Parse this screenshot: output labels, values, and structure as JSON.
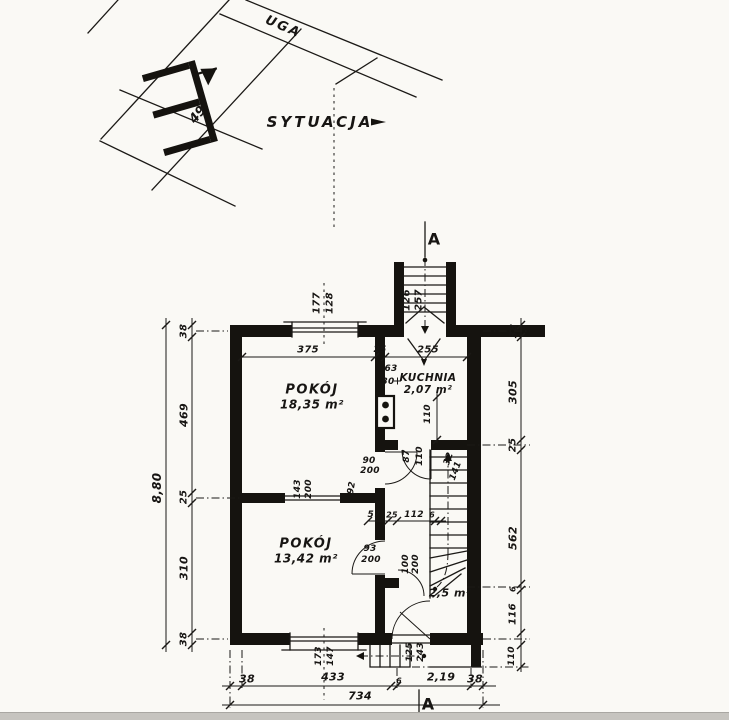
{
  "site_plan": {
    "street_name": "UGA",
    "title": "SYTUACJA",
    "building_number": "49"
  },
  "rooms": [
    {
      "name": "POKÓJ",
      "area": "18,35 m²"
    },
    {
      "name": "KUCHNIA",
      "area": "2,07 m²"
    },
    {
      "name": "POKÓJ",
      "area": "13,42 m²"
    },
    {
      "name": "",
      "area": "2,5 m²"
    }
  ],
  "section_markers": [
    {
      "label": "A"
    },
    {
      "label": "A"
    }
  ],
  "ink_color": "#15130f",
  "paper_color": "#faf9f5",
  "dimensions": [
    {
      "t": "177",
      "x": 317,
      "y": 303,
      "r": -90
    },
    {
      "t": "128",
      "x": 330,
      "y": 303,
      "r": -90
    },
    {
      "t": "126",
      "x": 407,
      "y": 300,
      "r": -90
    },
    {
      "t": "257",
      "x": 419,
      "y": 300,
      "r": -90
    },
    {
      "t": "375",
      "x": 308,
      "y": 350,
      "r": 0
    },
    {
      "t": "25",
      "x": 380,
      "y": 350,
      "r": 0,
      "s": 9
    },
    {
      "t": "255",
      "x": 428,
      "y": 350,
      "r": 0
    },
    {
      "t": "63",
      "x": 391,
      "y": 369,
      "r": 0,
      "s": 9
    },
    {
      "t": "30",
      "x": 388,
      "y": 382,
      "r": 0,
      "s": 9
    },
    {
      "t": "110",
      "x": 428,
      "y": 414,
      "r": -90,
      "s": 9
    },
    {
      "t": "87",
      "x": 407,
      "y": 456,
      "r": -90,
      "s": 9
    },
    {
      "t": "110",
      "x": 420,
      "y": 456,
      "r": -90,
      "s": 9
    },
    {
      "t": "90",
      "x": 369,
      "y": 461,
      "r": 0,
      "s": 9
    },
    {
      "t": "200",
      "x": 370,
      "y": 471,
      "r": 0,
      "s": 9
    },
    {
      "t": "32",
      "x": 449,
      "y": 459,
      "r": -70,
      "s": 9
    },
    {
      "t": "141",
      "x": 456,
      "y": 471,
      "r": -70,
      "s": 9
    },
    {
      "t": "57",
      "x": 374,
      "y": 515,
      "r": 0,
      "s": 9
    },
    {
      "t": "25",
      "x": 392,
      "y": 515,
      "r": 0,
      "s": 8
    },
    {
      "t": "112",
      "x": 414,
      "y": 515,
      "r": 0,
      "s": 9
    },
    {
      "t": "6",
      "x": 432,
      "y": 515,
      "r": 0,
      "s": 8
    },
    {
      "t": "93",
      "x": 370,
      "y": 549,
      "r": 0,
      "s": 9
    },
    {
      "t": "200",
      "x": 371,
      "y": 560,
      "r": 0,
      "s": 9
    },
    {
      "t": "100",
      "x": 406,
      "y": 564,
      "r": -90,
      "s": 9
    },
    {
      "t": "200",
      "x": 416,
      "y": 564,
      "r": -90,
      "s": 9
    },
    {
      "t": "143",
      "x": 298,
      "y": 489,
      "r": -90,
      "s": 9
    },
    {
      "t": "200",
      "x": 309,
      "y": 489,
      "r": -90,
      "s": 9
    },
    {
      "t": "92",
      "x": 352,
      "y": 488,
      "r": -80,
      "s": 9
    },
    {
      "t": "173",
      "x": 319,
      "y": 656,
      "r": -90,
      "s": 9
    },
    {
      "t": "147",
      "x": 331,
      "y": 656,
      "r": -90,
      "s": 9
    },
    {
      "t": "125",
      "x": 410,
      "y": 652,
      "r": -90,
      "s": 9
    },
    {
      "t": "243",
      "x": 421,
      "y": 652,
      "r": -90,
      "s": 9
    },
    {
      "t": "38",
      "x": 184,
      "y": 331,
      "r": -90
    },
    {
      "t": "469",
      "x": 184,
      "y": 415,
      "r": -90,
      "c": "big"
    },
    {
      "t": "25",
      "x": 184,
      "y": 497,
      "r": -90
    },
    {
      "t": "310",
      "x": 184,
      "y": 568,
      "r": -90,
      "c": "big"
    },
    {
      "t": "38",
      "x": 184,
      "y": 639,
      "r": -90
    },
    {
      "t": "8,80",
      "x": 157,
      "y": 488,
      "r": -90,
      "s": 12
    },
    {
      "t": "38",
      "x": 514,
      "y": 331,
      "r": -90
    },
    {
      "t": "305",
      "x": 513,
      "y": 392,
      "r": -90,
      "c": "big"
    },
    {
      "t": "25",
      "x": 513,
      "y": 445,
      "r": -90
    },
    {
      "t": "562",
      "x": 513,
      "y": 538,
      "r": -90,
      "c": "big"
    },
    {
      "t": "6",
      "x": 513,
      "y": 589,
      "r": -90,
      "s": 8
    },
    {
      "t": "116",
      "x": 513,
      "y": 614,
      "r": -90
    },
    {
      "t": "110",
      "x": 512,
      "y": 656,
      "r": -90,
      "s": 9
    },
    {
      "t": "38",
      "x": 247,
      "y": 679,
      "r": 0,
      "c": "big"
    },
    {
      "t": "433",
      "x": 333,
      "y": 677,
      "r": 0,
      "c": "big"
    },
    {
      "t": "6",
      "x": 399,
      "y": 681,
      "r": 0,
      "s": 8
    },
    {
      "t": "2,19",
      "x": 441,
      "y": 677,
      "r": 0,
      "c": "big"
    },
    {
      "t": "38",
      "x": 475,
      "y": 679,
      "r": 0,
      "c": "big"
    },
    {
      "t": "734",
      "x": 360,
      "y": 696,
      "r": 0,
      "c": "big"
    }
  ]
}
